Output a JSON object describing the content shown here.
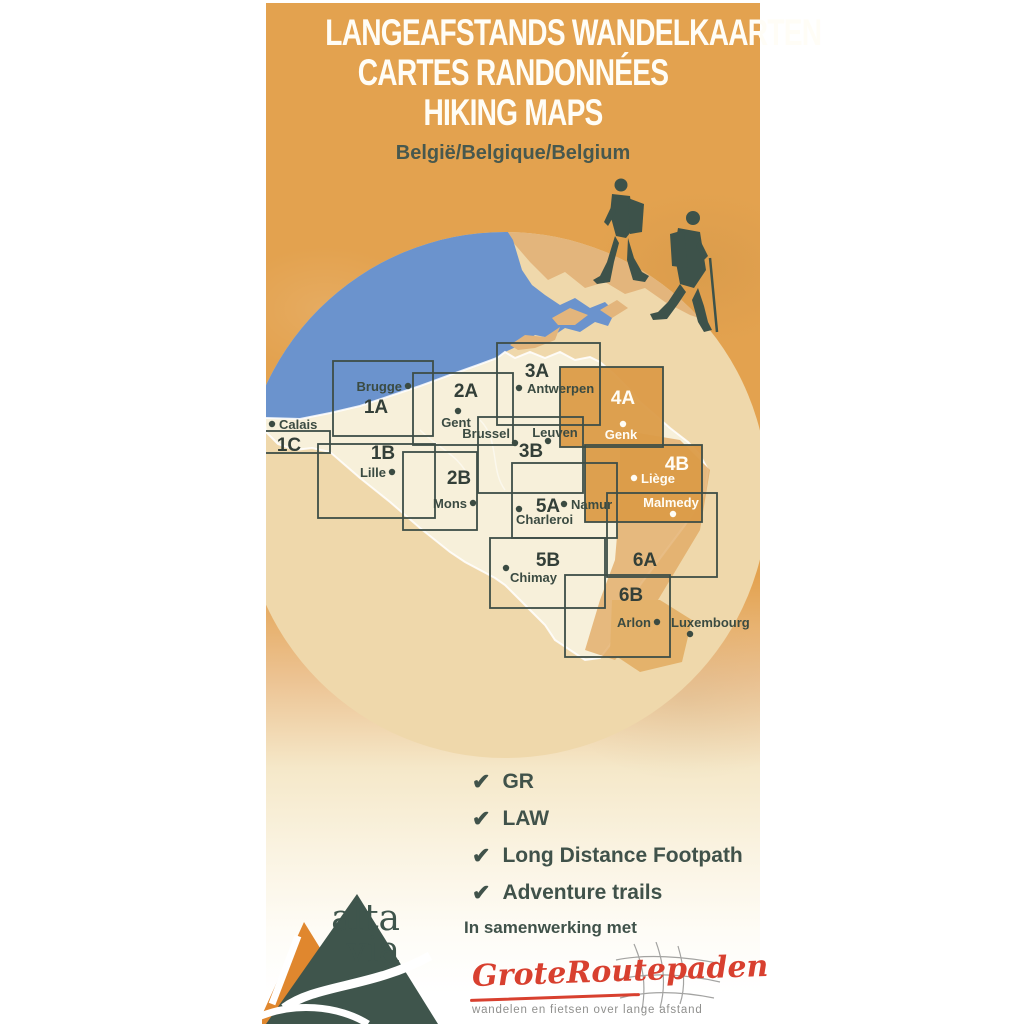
{
  "title": {
    "lines": [
      "LANGEAFSTANDS WANDELKAARTEN",
      "CARTES RANDONNÉES",
      "HIKING MAPS"
    ],
    "subtitle": "België/Belgique/Belgium"
  },
  "colors": {
    "cover_orange": "#e3a24f",
    "sea_blue": "#6b93cd",
    "circle_sand": "#efd8ab",
    "belgium_pale": "#f7f0da",
    "sheet_fill_orange": "#db9b48",
    "frame_line": "#3e4e47",
    "ink_dark": "#3b4b42",
    "label_white": "#fffdf6",
    "partner_red": "#d8402f",
    "brand_green": "#3f554c",
    "brand_orange": "#e0872e",
    "tagline_grey": "#8f8f8d"
  },
  "map": {
    "sheets": [
      {
        "id": "1A",
        "x": 333,
        "y": 361,
        "w": 100,
        "h": 75,
        "lx": 376,
        "ly": 413,
        "filled": false,
        "white": false
      },
      {
        "id": "2A",
        "x": 413,
        "y": 373,
        "w": 100,
        "h": 72,
        "lx": 466,
        "ly": 397,
        "filled": false,
        "white": false
      },
      {
        "id": "3A",
        "x": 497,
        "y": 343,
        "w": 103,
        "h": 82,
        "lx": 537,
        "ly": 377,
        "filled": false,
        "white": false
      },
      {
        "id": "4A",
        "x": 560,
        "y": 367,
        "w": 103,
        "h": 80,
        "lx": 623,
        "ly": 404,
        "filled": true,
        "white": true
      },
      {
        "id": "1C",
        "x": 238,
        "y": 431,
        "w": 92,
        "h": 22,
        "lx": 289,
        "ly": 451,
        "filled": false,
        "white": false
      },
      {
        "id": "1B",
        "x": 318,
        "y": 444,
        "w": 117,
        "h": 74,
        "lx": 383,
        "ly": 459,
        "filled": false,
        "white": false
      },
      {
        "id": "2B",
        "x": 403,
        "y": 452,
        "w": 74,
        "h": 78,
        "lx": 459,
        "ly": 484,
        "filled": false,
        "white": false
      },
      {
        "id": "3B",
        "x": 478,
        "y": 417,
        "w": 105,
        "h": 76,
        "lx": 531,
        "ly": 457,
        "filled": false,
        "white": false
      },
      {
        "id": "4B",
        "x": 585,
        "y": 445,
        "w": 117,
        "h": 77,
        "lx": 677,
        "ly": 470,
        "filled": true,
        "white": true
      },
      {
        "id": "5A",
        "x": 512,
        "y": 463,
        "w": 105,
        "h": 75,
        "lx": 548,
        "ly": 512,
        "filled": false,
        "white": false
      },
      {
        "id": "5B",
        "x": 490,
        "y": 538,
        "w": 115,
        "h": 70,
        "lx": 548,
        "ly": 566,
        "filled": false,
        "white": false
      },
      {
        "id": "6A",
        "x": 607,
        "y": 493,
        "w": 110,
        "h": 84,
        "lx": 645,
        "ly": 566,
        "filled": false,
        "white": false
      },
      {
        "id": "6B",
        "x": 565,
        "y": 575,
        "w": 105,
        "h": 82,
        "lx": 631,
        "ly": 601,
        "filled": false,
        "white": false
      }
    ],
    "cities": [
      {
        "name": "Brugge",
        "dx": 408,
        "dy": 386,
        "tx": 402,
        "ty": 391,
        "anchor": "end",
        "white": false
      },
      {
        "name": "Calais",
        "dx": 272,
        "dy": 424,
        "tx": 279,
        "ty": 429,
        "anchor": "start",
        "white": false
      },
      {
        "name": "Lille",
        "dx": 392,
        "dy": 472,
        "tx": 386,
        "ty": 477,
        "anchor": "end",
        "white": false
      },
      {
        "name": "Gent",
        "dx": 458,
        "dy": 411,
        "tx": 456,
        "ty": 427,
        "anchor": "middle",
        "white": false
      },
      {
        "name": "Antwerpen",
        "dx": 519,
        "dy": 388,
        "tx": 527,
        "ty": 393,
        "anchor": "start",
        "white": false
      },
      {
        "name": "Brussel",
        "dx": 515,
        "dy": 443,
        "tx": 510,
        "ty": 438,
        "anchor": "end",
        "white": false
      },
      {
        "name": "Leuven",
        "dx": 548,
        "dy": 441,
        "tx": 555,
        "ty": 437,
        "anchor": "middle",
        "white": false
      },
      {
        "name": "Genk",
        "dx": 623,
        "dy": 424,
        "tx": 621,
        "ty": 439,
        "anchor": "middle",
        "white": true
      },
      {
        "name": "Liège",
        "dx": 634,
        "dy": 478,
        "tx": 641,
        "ty": 483,
        "anchor": "start",
        "white": true
      },
      {
        "name": "Namur",
        "dx": 564,
        "dy": 504,
        "tx": 571,
        "ty": 509,
        "anchor": "start",
        "white": false
      },
      {
        "name": "Charleroi",
        "dx": 519,
        "dy": 509,
        "tx": 516,
        "ty": 524,
        "anchor": "start",
        "white": false
      },
      {
        "name": "Mons",
        "dx": 473,
        "dy": 503,
        "tx": 467,
        "ty": 508,
        "anchor": "end",
        "white": false
      },
      {
        "name": "Malmedy",
        "dx": 673,
        "dy": 514,
        "tx": 671,
        "ty": 507,
        "anchor": "middle",
        "white": true
      },
      {
        "name": "Chimay",
        "dx": 506,
        "dy": 568,
        "tx": 510,
        "ty": 582,
        "anchor": "start",
        "white": false
      },
      {
        "name": "Arlon",
        "dx": 657,
        "dy": 622,
        "tx": 651,
        "ty": 627,
        "anchor": "end",
        "white": false
      },
      {
        "name": "Luxembourg",
        "dx": 690,
        "dy": 634,
        "tx": 671,
        "ty": 627,
        "anchor": "start",
        "white": false
      }
    ]
  },
  "features": {
    "check": "✔",
    "items": [
      "GR",
      "LAW",
      "Long Distance Footpath",
      "Adventure trails"
    ]
  },
  "brand": {
    "line1": "alta",
    "line2": "via"
  },
  "partner": {
    "intro": "In samenwerking met",
    "name": "GroteRoutepaden",
    "tagline": "wandelen en fietsen over lange afstand"
  }
}
